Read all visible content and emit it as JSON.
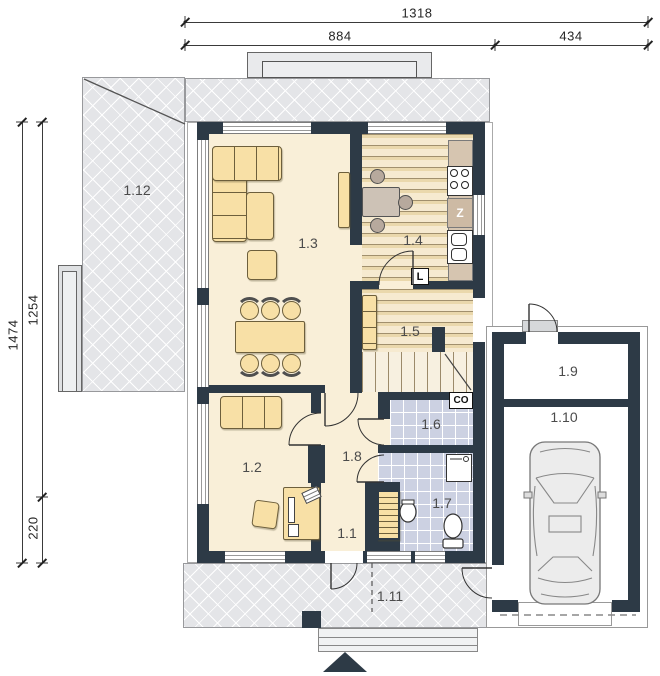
{
  "dimensions": {
    "top": [
      {
        "value": "1318"
      },
      {
        "value": "884"
      },
      {
        "value": "434"
      }
    ],
    "left": [
      {
        "value": "1474"
      },
      {
        "value": "1254"
      },
      {
        "value": "220"
      }
    ]
  },
  "rooms": [
    {
      "label": "1.1"
    },
    {
      "label": "1.2"
    },
    {
      "label": "1.3"
    },
    {
      "label": "1.4"
    },
    {
      "label": "1.5"
    },
    {
      "label": "1.6"
    },
    {
      "label": "1.7"
    },
    {
      "label": "1.8"
    },
    {
      "label": "1.9"
    },
    {
      "label": "1.10"
    },
    {
      "label": "1.11"
    },
    {
      "label": "1.12"
    }
  ],
  "appliances": {
    "dishwasher": "Z",
    "fridge": "L",
    "boiler": "CO"
  },
  "colors": {
    "wall": "#2d3a46",
    "floor": "#f9efd8",
    "wood_floor": "#f0dfb5",
    "tile_floor": "#ccd1e2",
    "terrace": "#e4e5e8",
    "furniture": "#f8e0a6",
    "counter": "#d6c5b0"
  }
}
